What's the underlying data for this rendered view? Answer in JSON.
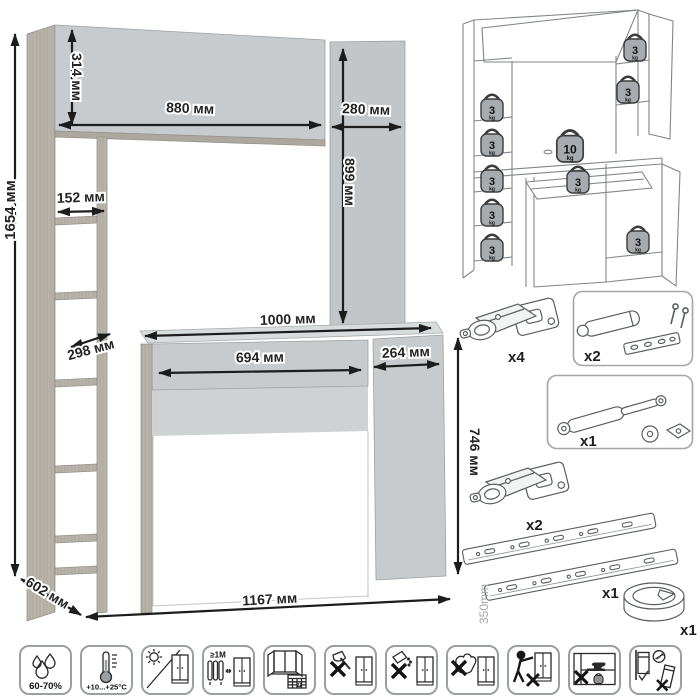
{
  "drawing": {
    "dimensions": {
      "total_height": "1654 мм",
      "hutch_height": "314 мм",
      "hutch_width": "880 мм",
      "side_column_width": "280 мм",
      "side_column_height": "899 мм",
      "shelf_width": "152 мм",
      "shelf_depth": "298 мм",
      "desktop_width": "1000 мм",
      "drawer_width": "694 мм",
      "door_width": "264 мм",
      "desk_height": "746 мм",
      "depth": "602 мм",
      "total_width": "1167 мм"
    }
  },
  "load_diagram": {
    "weights": [
      {
        "value": "3",
        "unit": "kg"
      },
      {
        "value": "3",
        "unit": "kg"
      },
      {
        "value": "3",
        "unit": "kg"
      },
      {
        "value": "3",
        "unit": "kg"
      },
      {
        "value": "3",
        "unit": "kg"
      },
      {
        "value": "3",
        "unit": "kg"
      },
      {
        "value": "3",
        "unit": "kg"
      },
      {
        "value": "10",
        "unit": "kg"
      },
      {
        "value": "3",
        "unit": "kg"
      },
      {
        "value": "3",
        "unit": "kg"
      }
    ]
  },
  "hardware": {
    "items": [
      {
        "name": "concealed-hinge",
        "qty": "x4"
      },
      {
        "name": "door-damper",
        "qty": "x2"
      },
      {
        "name": "gas-lift",
        "qty": "x1"
      },
      {
        "name": "concealed-hinge",
        "qty": "x2"
      },
      {
        "name": "ball-bearing-slides",
        "qty": "x1",
        "length": "350mm"
      },
      {
        "name": "cable-grommet",
        "qty": "x1"
      }
    ]
  },
  "care_icons": [
    {
      "name": "humidity",
      "text": "60-70%"
    },
    {
      "name": "temperature",
      "text": "+10...+25°С"
    },
    {
      "name": "no-direct-sunlight"
    },
    {
      "name": "heat-distance",
      "text": "≥1М"
    },
    {
      "name": "ventilation-calendar",
      "text": "21"
    },
    {
      "name": "no-sharp-tools"
    },
    {
      "name": "no-abrasives"
    },
    {
      "name": "no-wet-cleaning"
    },
    {
      "name": "no-dragging"
    },
    {
      "name": "no-heavy-load"
    },
    {
      "name": "wall-anchoring"
    }
  ]
}
